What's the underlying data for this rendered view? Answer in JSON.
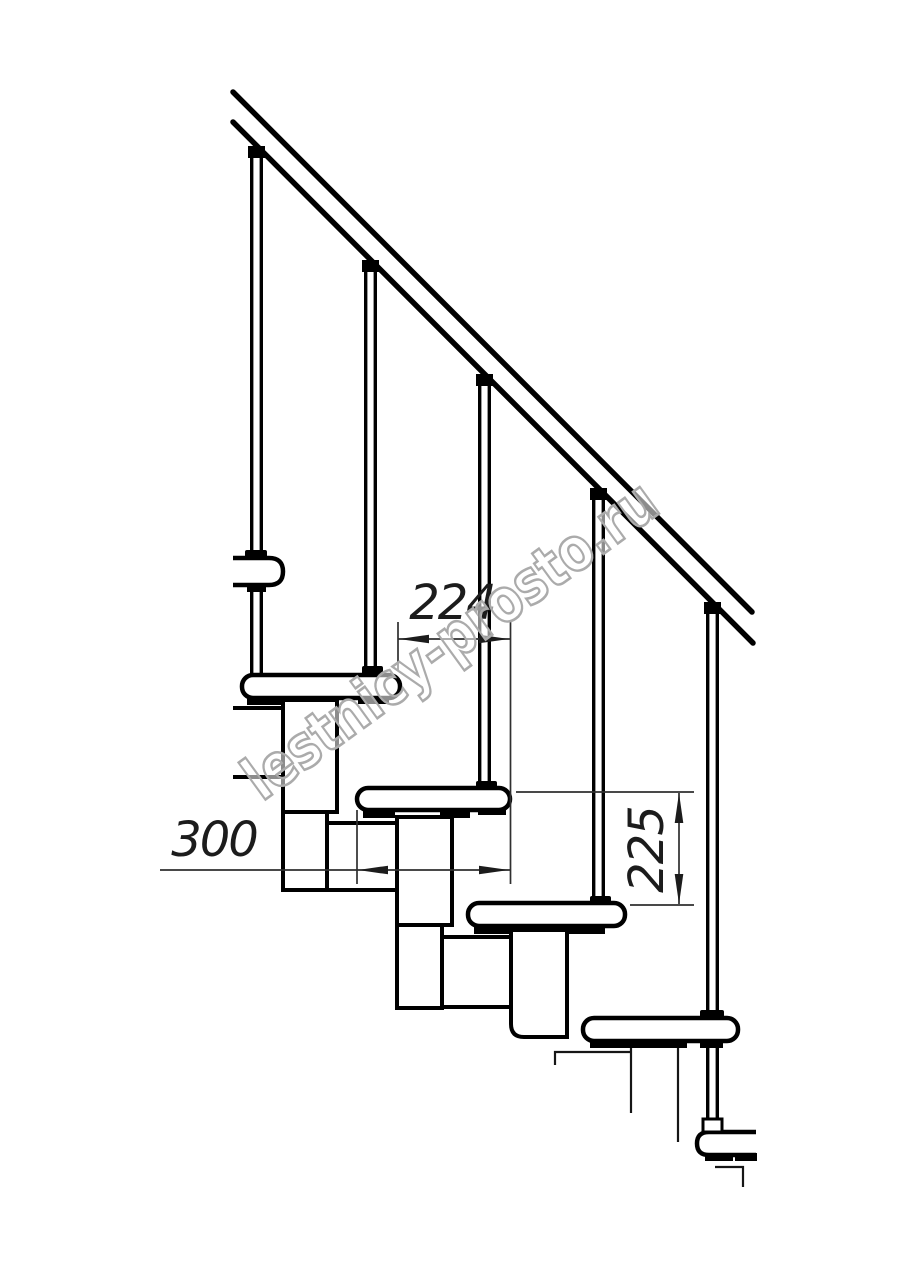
{
  "drawing": {
    "dimension_labels": {
      "horizontal_run": "224",
      "tread_depth": "300",
      "riser_height": "225"
    },
    "watermark_text": "lestnicy-prosto.ru",
    "colors": {
      "line": "#000000",
      "dimension_line": "#2f2f2f",
      "watermark_outline": "#ababab"
    },
    "counts": {
      "treads": 6,
      "balusters": 5
    }
  }
}
